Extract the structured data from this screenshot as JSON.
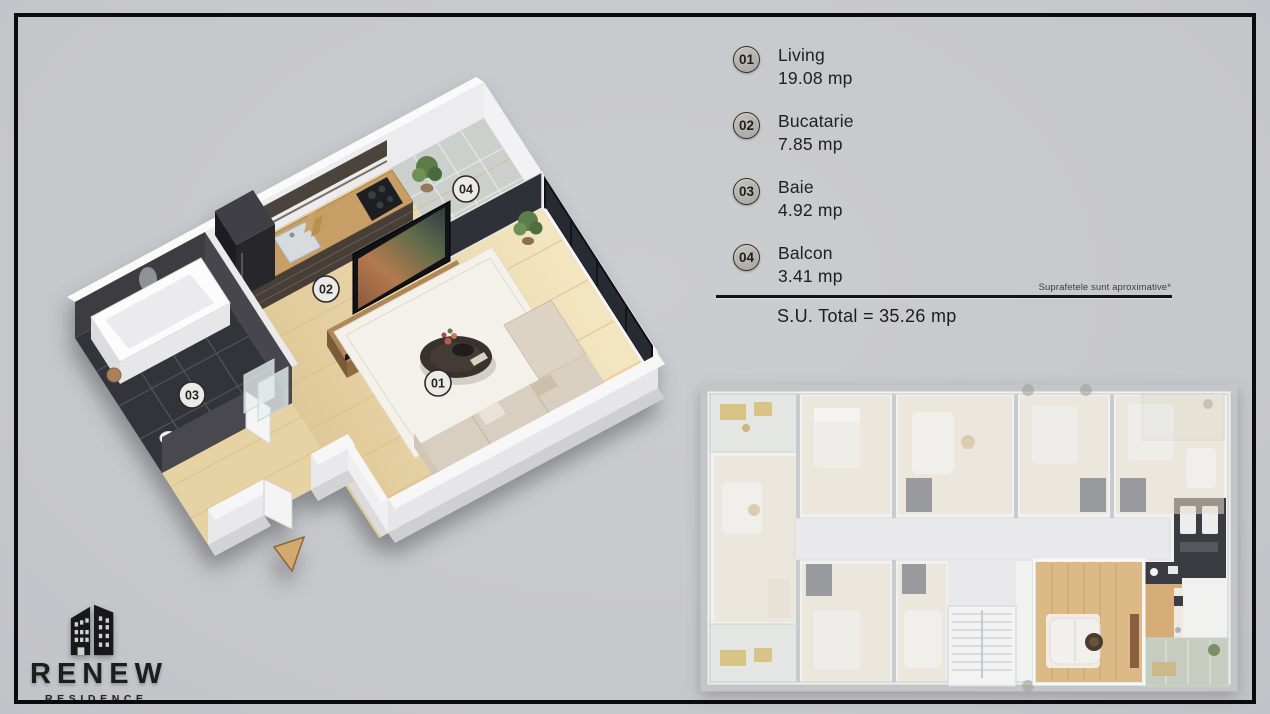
{
  "legend": {
    "items": [
      {
        "number": "01",
        "name": "Living",
        "area": "19.08 mp"
      },
      {
        "number": "02",
        "name": "Bucatarie",
        "area": "7.85 mp"
      },
      {
        "number": "03",
        "name": "Baie",
        "area": "4.92 mp"
      },
      {
        "number": "04",
        "name": "Balcon",
        "area": "3.41 mp"
      }
    ],
    "note": "Suprafetele sunt aproximative*",
    "total": "S.U. Total = 35.26 mp"
  },
  "plan3d": {
    "badges": [
      "01",
      "02",
      "03",
      "04"
    ]
  },
  "brand": {
    "name": "RENEW",
    "sub": "RESIDENCE"
  },
  "colors": {
    "background": "#c8c9cd",
    "frame": "#0b0b0d",
    "wood_floor": "#ead7ad",
    "highlight_wood": "#dcba88",
    "badge_fill": "#b5b2ab",
    "dark_tile": "#33343a"
  }
}
